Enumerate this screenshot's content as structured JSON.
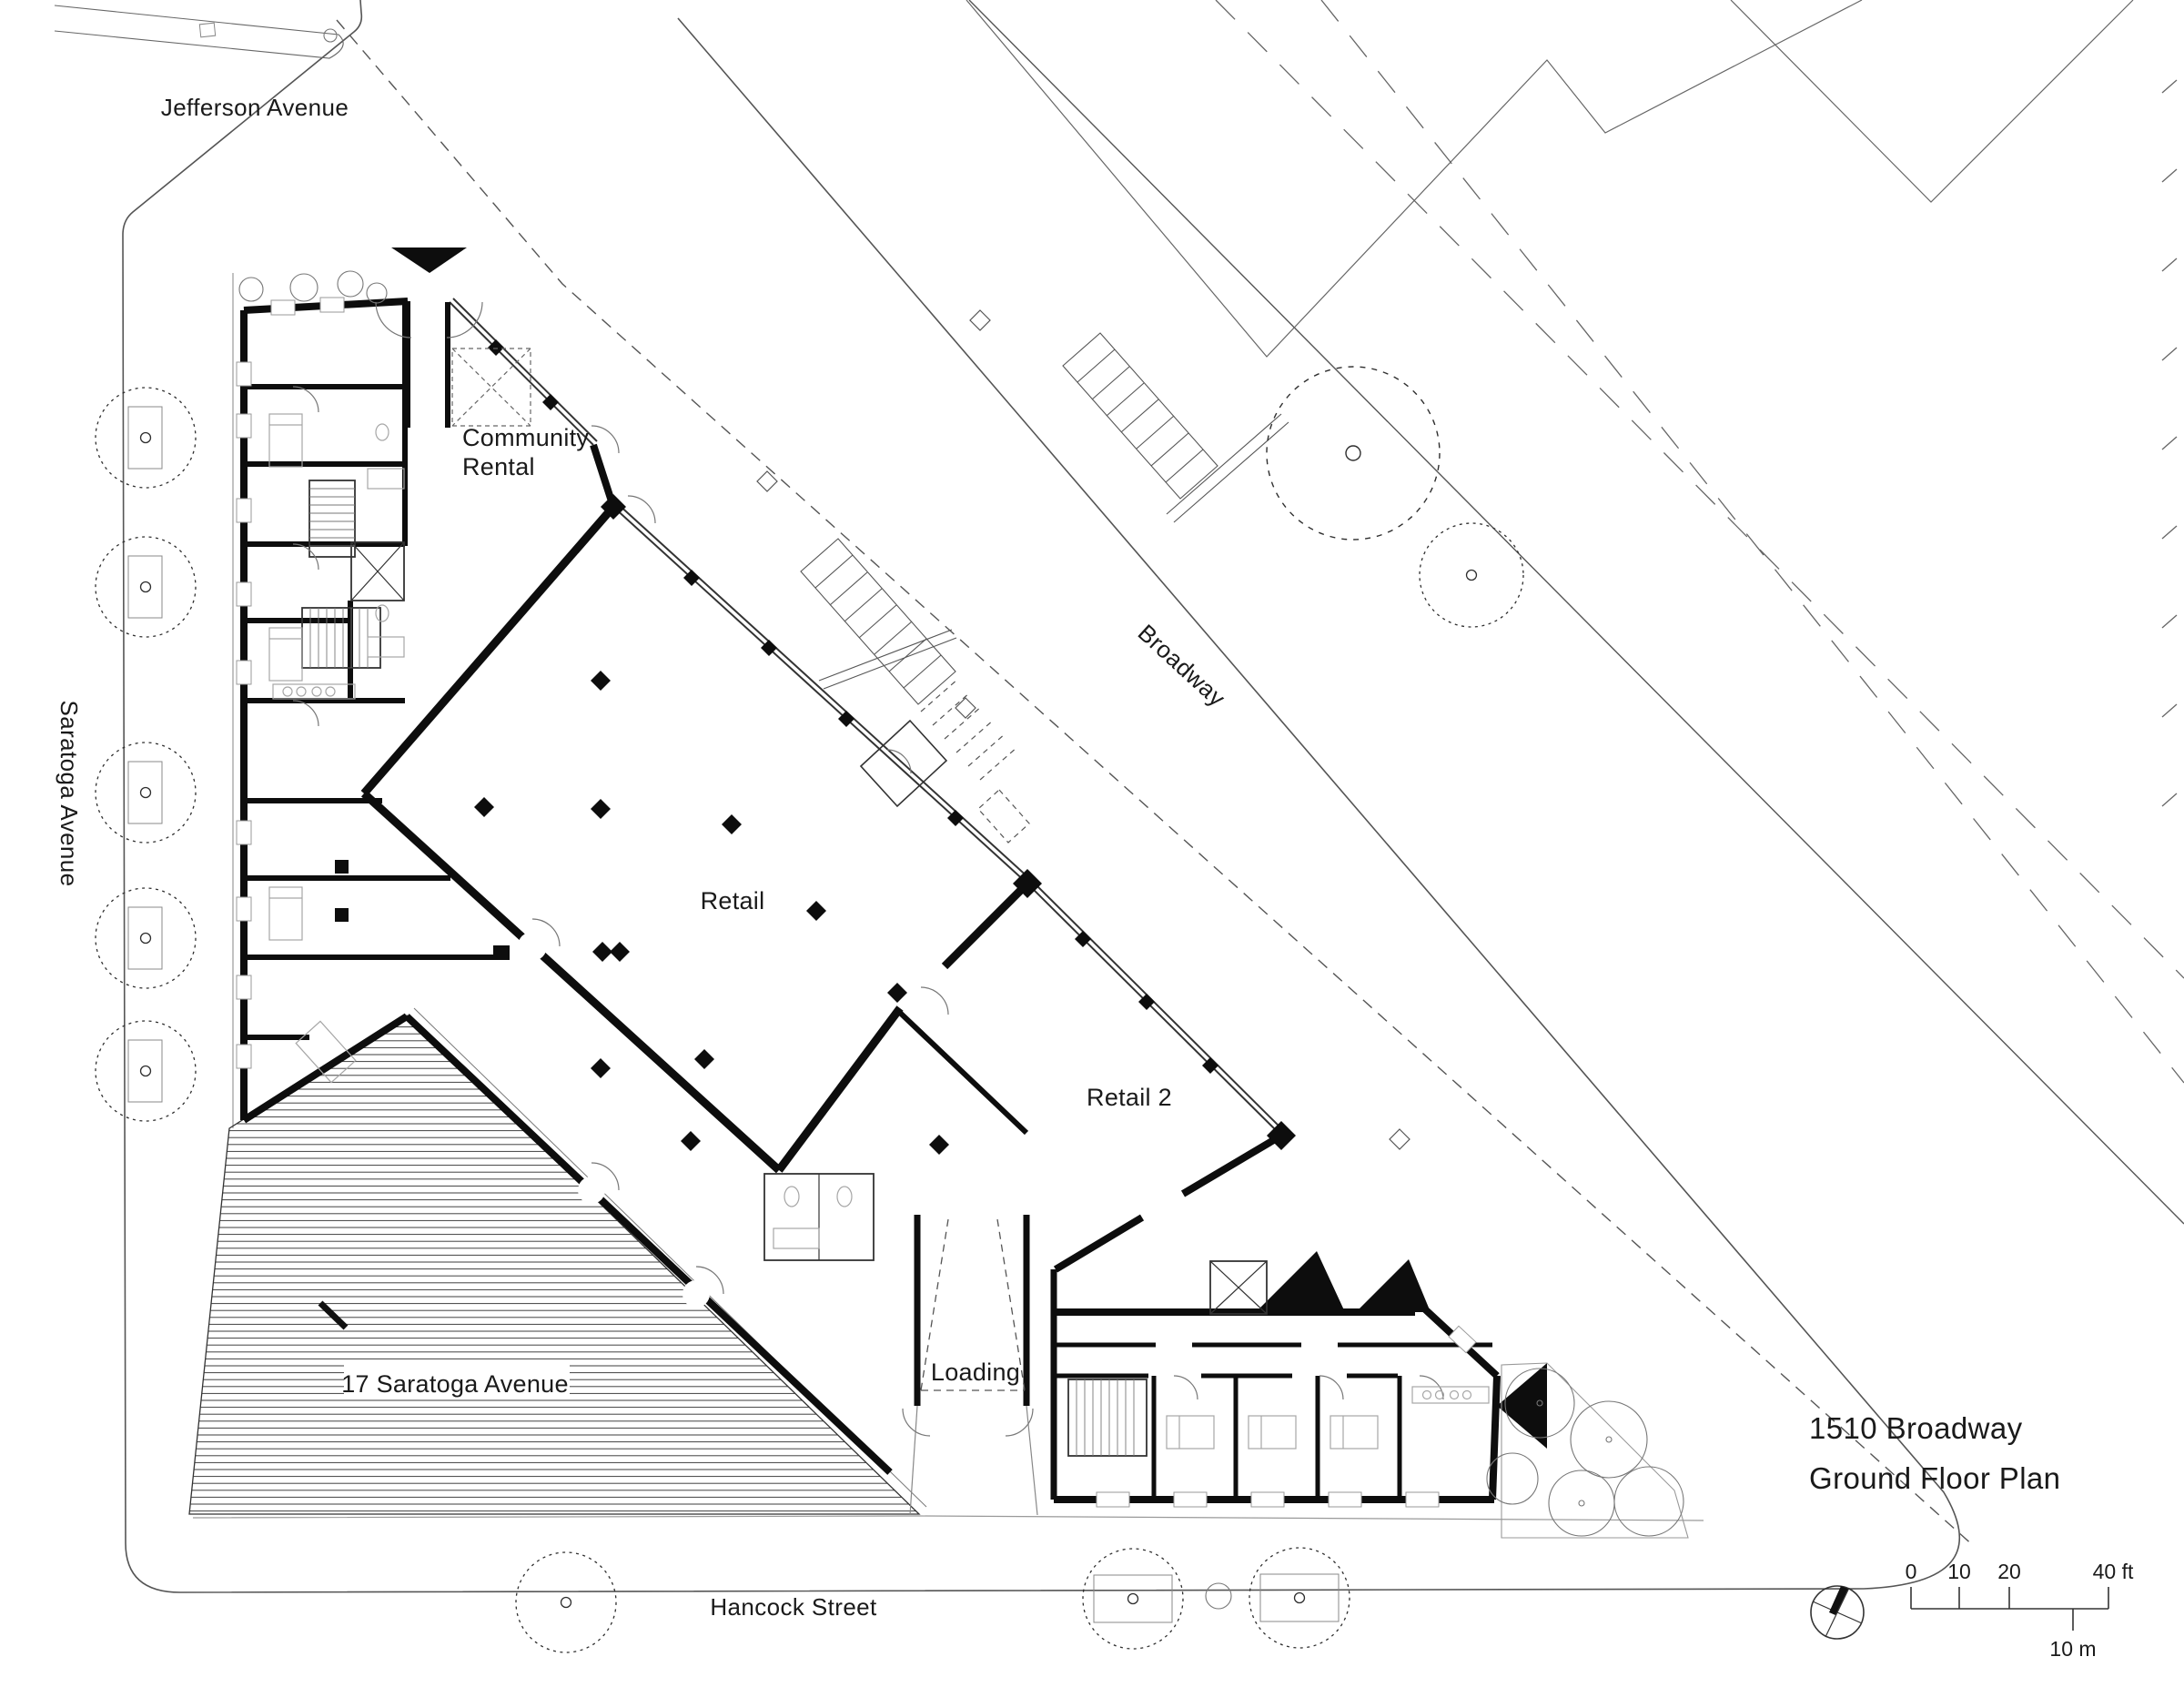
{
  "plan": {
    "title": {
      "line1": "1510 Broadway",
      "line2": "Ground Floor Plan"
    },
    "streets": {
      "jefferson": "Jefferson Avenue",
      "saratoga": "Saratoga Avenue",
      "broadway": "Broadway",
      "hancock": "Hancock Street"
    },
    "spaces": {
      "community_line1": "Community",
      "community_line2": "Rental",
      "retail": "Retail",
      "retail_2": "Retail 2",
      "loading": "Loading",
      "neighbor_building": "17 Saratoga Avenue"
    },
    "scale_bar": {
      "t0": "0",
      "t10": "10",
      "t20": "20",
      "t40": "40 ft",
      "metric": "10 m"
    },
    "icons": {
      "north_arrow": "compass-north-arrow"
    },
    "colors": {
      "ink": "#1a1a1a",
      "wall": "#0d0d0d",
      "street_line": "#555555"
    }
  }
}
